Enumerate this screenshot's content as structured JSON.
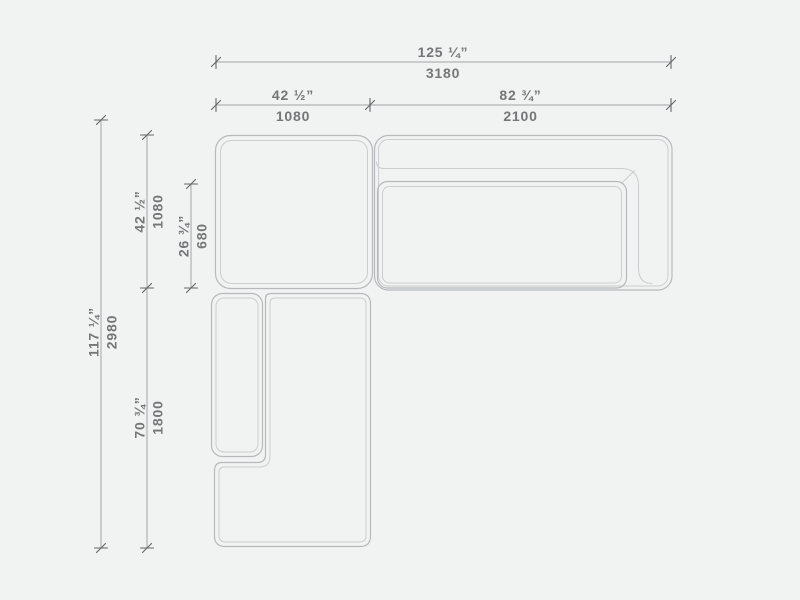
{
  "page": {
    "background": "#f1f2f2",
    "type": "technical dimension drawing",
    "subject": "L-shaped sectional sofa, top view"
  },
  "colors": {
    "outline": "#b7babc",
    "outline_light": "#cbcdce",
    "dim_line": "#a2a4a5",
    "tick": "#646668",
    "label_text": "#767678"
  },
  "dims": {
    "total_width": {
      "in": "125 ¼”",
      "mm": "3180"
    },
    "left_width": {
      "in": "42 ½”",
      "mm": "1080"
    },
    "right_width": {
      "in": "82 ¾”",
      "mm": "2100"
    },
    "total_depth": {
      "in": "117 ¼”",
      "mm": "2980"
    },
    "corner_depth": {
      "in": "42 ½”",
      "mm": "1080"
    },
    "seat_depth": {
      "in": "26 ¾”",
      "mm": "680"
    },
    "chaise_depth": {
      "in": "70 ¾”",
      "mm": "1800"
    }
  }
}
